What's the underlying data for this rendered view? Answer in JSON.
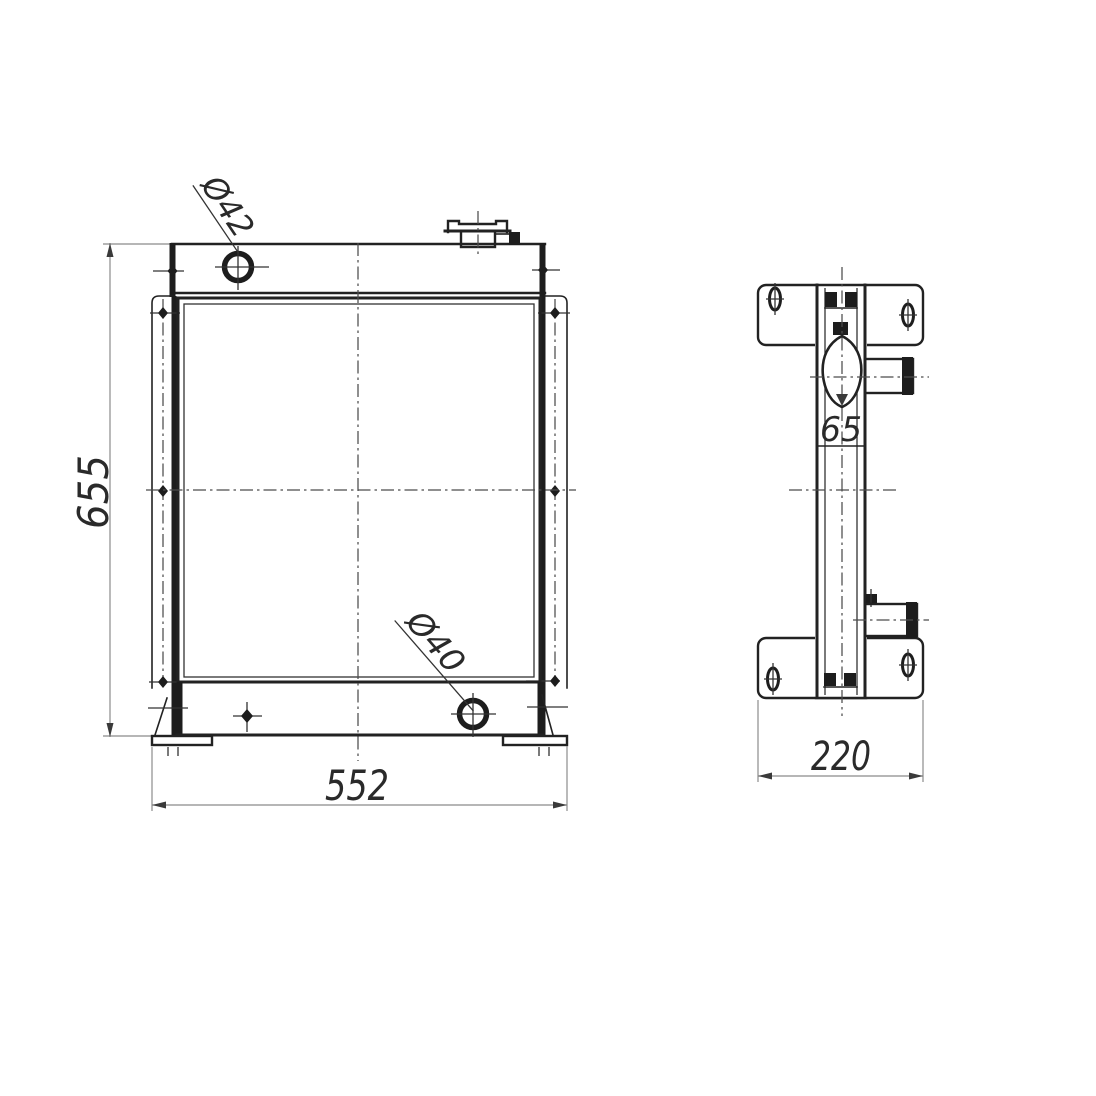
{
  "drawing": {
    "front_view": {
      "height": "655",
      "width": "552",
      "inlet_diameter": "Ø42",
      "outlet_diameter": "Ø40"
    },
    "side_view": {
      "depth": "220",
      "filler_offset": "65"
    },
    "colors": {
      "line": "#222222",
      "dimension": "#8b8b8b",
      "background": "#ffffff"
    }
  }
}
